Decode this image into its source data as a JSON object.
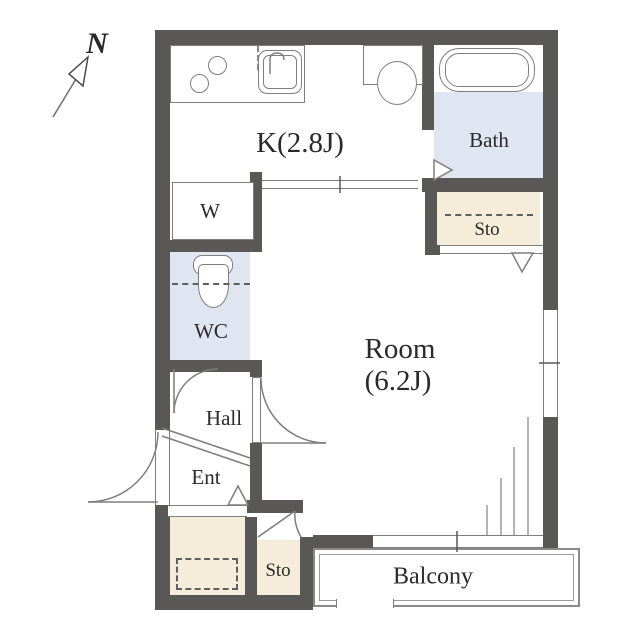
{
  "plan": {
    "compass": {
      "label": "N"
    },
    "rooms": {
      "kitchen": {
        "label": "K(2.8J)"
      },
      "bath": {
        "label": "Bath"
      },
      "storage_top": {
        "label": "Sto"
      },
      "washer": {
        "label": "W"
      },
      "wc": {
        "label": "WC"
      },
      "hall": {
        "label": "Hall"
      },
      "entrance": {
        "label": "Ent"
      },
      "storage_bottom": {
        "label": "Sto"
      },
      "main_room": {
        "label_line1": "Room",
        "label_line2": "(6.2J)"
      },
      "balcony": {
        "label": "Balcony"
      }
    },
    "colors": {
      "wall": "#5a5757",
      "wet_floor": "#dfe5f1",
      "storage_floor": "#f5ecd9",
      "fixture_line": "#7e7e7e",
      "text": "#2a2a2a"
    }
  }
}
